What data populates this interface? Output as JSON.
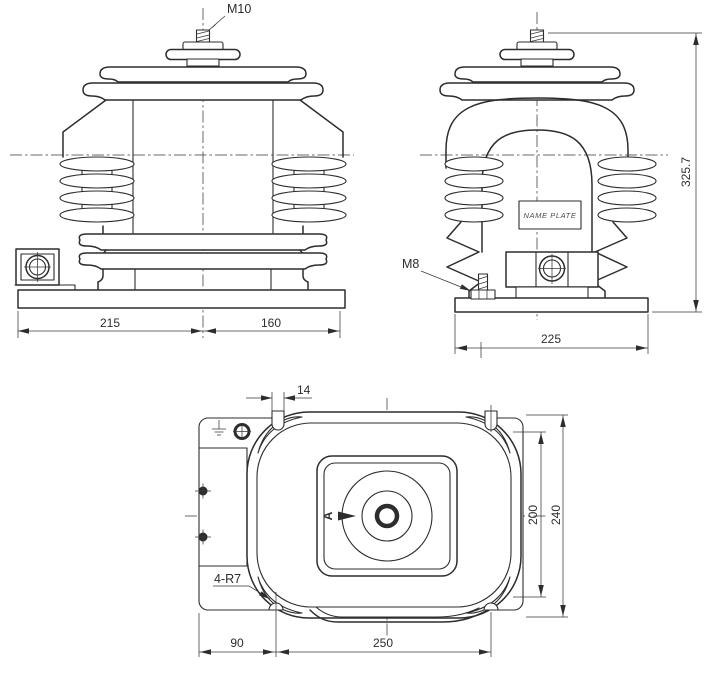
{
  "front_view": {
    "label_m10": "M10",
    "dim_left": "215",
    "dim_right": "160"
  },
  "side_view": {
    "label_m8": "M8",
    "nameplate": "NAME PLATE",
    "dim_height": "325.7",
    "dim_width": "225"
  },
  "plan_view": {
    "label_slots": "4-R7",
    "label_view_arrow": "A",
    "dim_slot_width": "14",
    "dim_inner_height": "200",
    "dim_outer_height": "240",
    "dim_left_offset": "90",
    "dim_slot_spacing": "250"
  },
  "colors": {
    "line": "#2d2d2d",
    "background": "#ffffff"
  }
}
